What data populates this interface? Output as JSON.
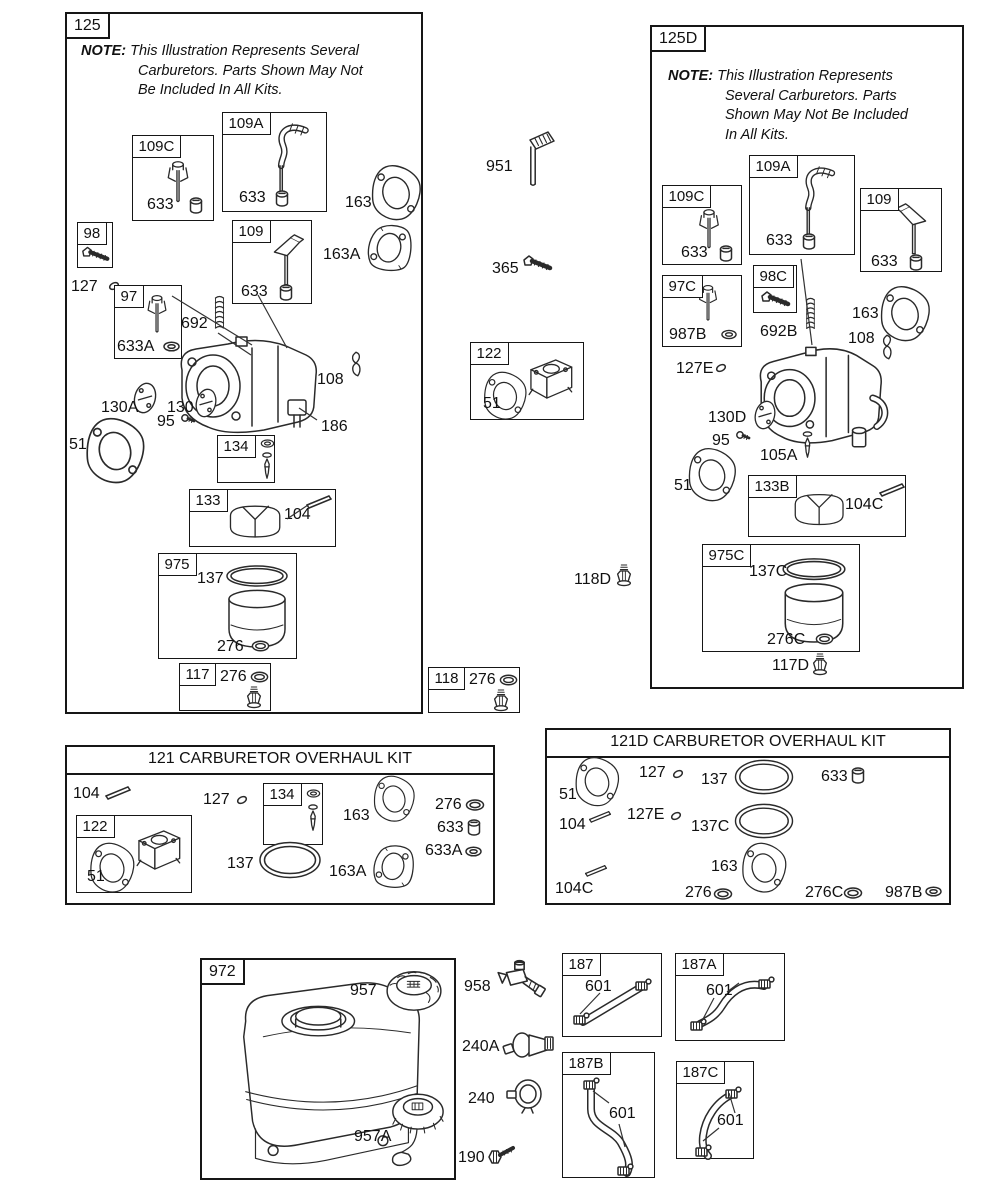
{
  "colors": {
    "ink": "#161616",
    "bg": "#ffffff"
  },
  "notes": {
    "n125": {
      "head": "NOTE:",
      "lines": [
        "This Illustration Represents Several",
        "Carburetors. Parts Shown May Not",
        "Be Included In All Kits."
      ]
    },
    "n125d": {
      "head": "NOTE:",
      "lines": [
        "This Illustration Represents",
        "Several Carburetors. Parts",
        "Shown May Not Be Included",
        "In All Kits."
      ]
    }
  },
  "titles": {
    "kit121": "121 CARBURETOR OVERHAUL KIT",
    "kit121d": "121D CARBURETOR OVERHAUL KIT"
  },
  "tags": {
    "125": "125",
    "125D": "125D",
    "109C": "109C",
    "109A": "109A",
    "109": "109",
    "98": "98",
    "98C": "98C",
    "97": "97",
    "97C": "97C",
    "134": "134",
    "133": "133",
    "133B": "133B",
    "975": "975",
    "975C": "975C",
    "117": "117",
    "122": "122",
    "118": "118",
    "972": "972",
    "187": "187",
    "187A": "187A",
    "187B": "187B",
    "187C": "187C"
  },
  "parts": {
    "51": "51",
    "95": "95",
    "104": "104",
    "104C": "104C",
    "105A": "105A",
    "108": "108",
    "117D": "117D",
    "118D": "118D",
    "127": "127",
    "127E": "127E",
    "130": "130",
    "130A": "130A",
    "130D": "130D",
    "137": "137",
    "137C": "137C",
    "163": "163",
    "163A": "163A",
    "186": "186",
    "190": "190",
    "240": "240",
    "240A": "240A",
    "276": "276",
    "276C": "276C",
    "365": "365",
    "601": "601",
    "633": "633",
    "633A": "633A",
    "692": "692",
    "692B": "692B",
    "951": "951",
    "957": "957",
    "957A": "957A",
    "958": "958",
    "987B": "987B"
  }
}
